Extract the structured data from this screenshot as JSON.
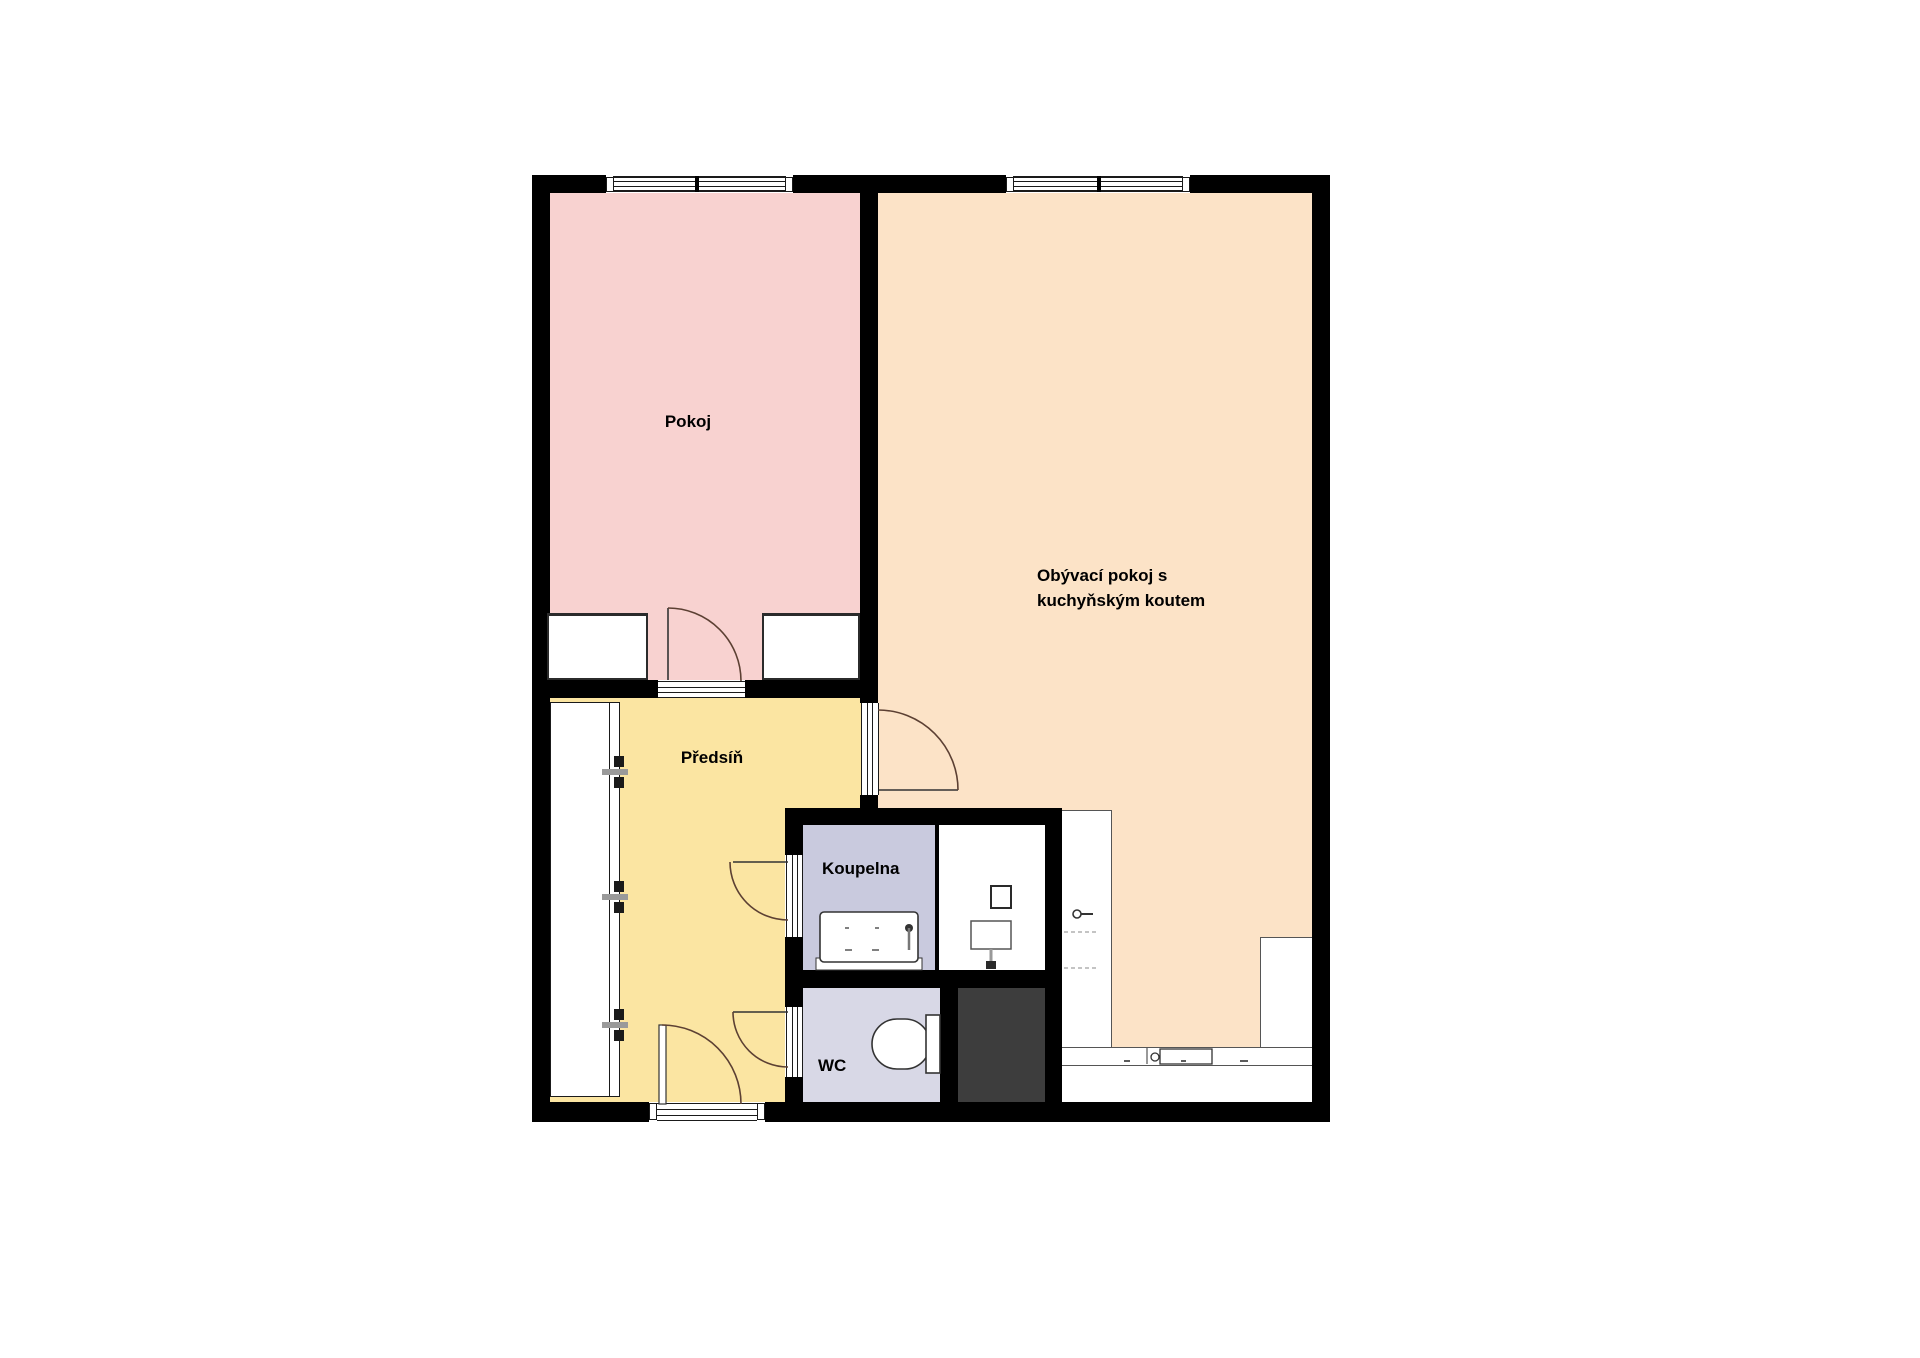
{
  "rooms": {
    "pokoj": {
      "label": "Pokoj",
      "color": "#f8d2d0"
    },
    "living": {
      "label_line1": "Obývací pokoj s",
      "label_line2": "kuchyňským koutem",
      "color": "#fce3c7"
    },
    "hall": {
      "label": "Předsíň",
      "color": "#fbe5a2"
    },
    "bath": {
      "label": "Koupelna",
      "color": "#c9cade"
    },
    "wc": {
      "label": "WC",
      "color": "#d8d8e6"
    }
  },
  "palette": {
    "wall": "#000000",
    "shaft": "#3d3d3d",
    "door_arc": "#5c4033",
    "fixture_outline": "#333333",
    "background": "#ffffff"
  },
  "fixtures": [
    "window",
    "door-swing",
    "bathtub",
    "toilet",
    "washing-machine",
    "sink",
    "kitchen-faucet",
    "cooktop",
    "built-in-closet",
    "wardrobe",
    "shaft"
  ]
}
